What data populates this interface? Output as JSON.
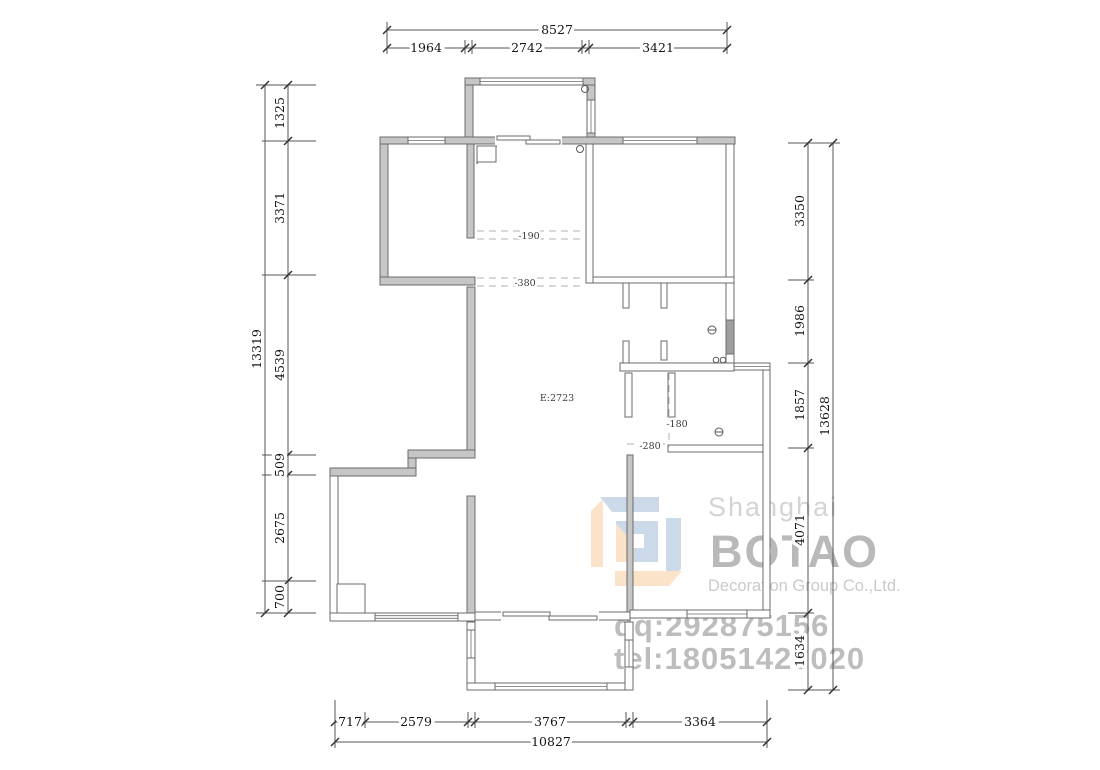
{
  "plan": {
    "area_label": "E:2723",
    "levels": {
      "kitchen": "-190",
      "dining": "-380",
      "bath_upper": "-180",
      "bath_lower": "-280"
    },
    "colors": {
      "wall_fill": "#c6c6c6",
      "wall_line": "#6b6b6b"
    }
  },
  "dims": {
    "top": {
      "total": "8527",
      "segments": [
        "1964",
        "2742",
        "3421"
      ]
    },
    "left": {
      "total": "13319",
      "segments": [
        "1325",
        "3371",
        "4539",
        "509",
        "2675",
        "700"
      ]
    },
    "right": {
      "total": "13628",
      "segments": [
        "3350",
        "1986",
        "1857",
        "4071",
        "1634"
      ]
    },
    "bottom": {
      "total": "10827",
      "segments": [
        "717",
        "2579",
        "3767",
        "3364"
      ]
    }
  },
  "watermark": {
    "city": "Shanghai",
    "brand": "BOTAO",
    "company": "Decoration Group Co.,Ltd.",
    "qq": "qq:292875156",
    "tel": "tel:18051428020",
    "colors": {
      "logo_blue": "#ccd9e8",
      "logo_orange": "#fbe3ca"
    }
  }
}
